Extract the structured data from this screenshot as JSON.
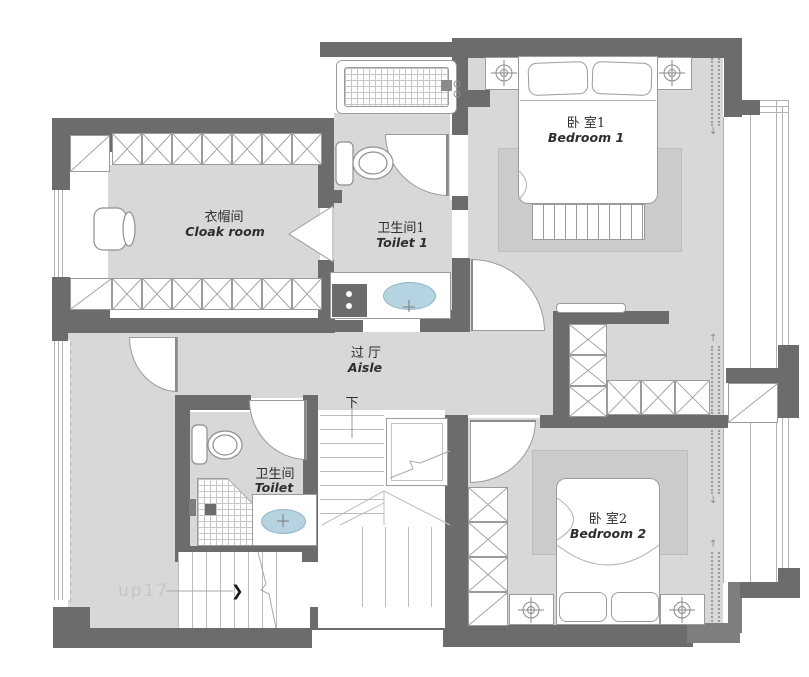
{
  "rooms": [
    {
      "key": "cloak_room",
      "label_zh": "衣帽间",
      "label_en": "Cloak room"
    },
    {
      "key": "toilet_1",
      "label_zh": "卫生间1",
      "label_en": "Toilet 1"
    },
    {
      "key": "bedroom_1",
      "label_zh": "卧 室1",
      "label_en": "Bedroom 1"
    },
    {
      "key": "aisle",
      "label_zh": "过 厅",
      "label_en": "Aisle"
    },
    {
      "key": "toilet",
      "label_zh": "卫生间",
      "label_en": "Toilet"
    },
    {
      "key": "bedroom_2",
      "label_zh": "卧 室2",
      "label_en": "Bedroom 2"
    }
  ],
  "annotations": {
    "down": "下",
    "up": "up17"
  },
  "icons": {
    "stair_direction_arrow": "❯",
    "curtain_arrow_up": "↑",
    "curtain_arrow_down": "↓"
  },
  "colors": {
    "wall": "#6c6c6e",
    "wall_light": "#7e7e80",
    "floor": "#d8d8d9",
    "rug": "#cbcbcc",
    "line": "#9b9b9d",
    "sink_fill": "#b5d3e0",
    "sink_stroke": "#8fb4c4",
    "faint_text": "#c5c5c6",
    "text": "#2e2e2f"
  }
}
